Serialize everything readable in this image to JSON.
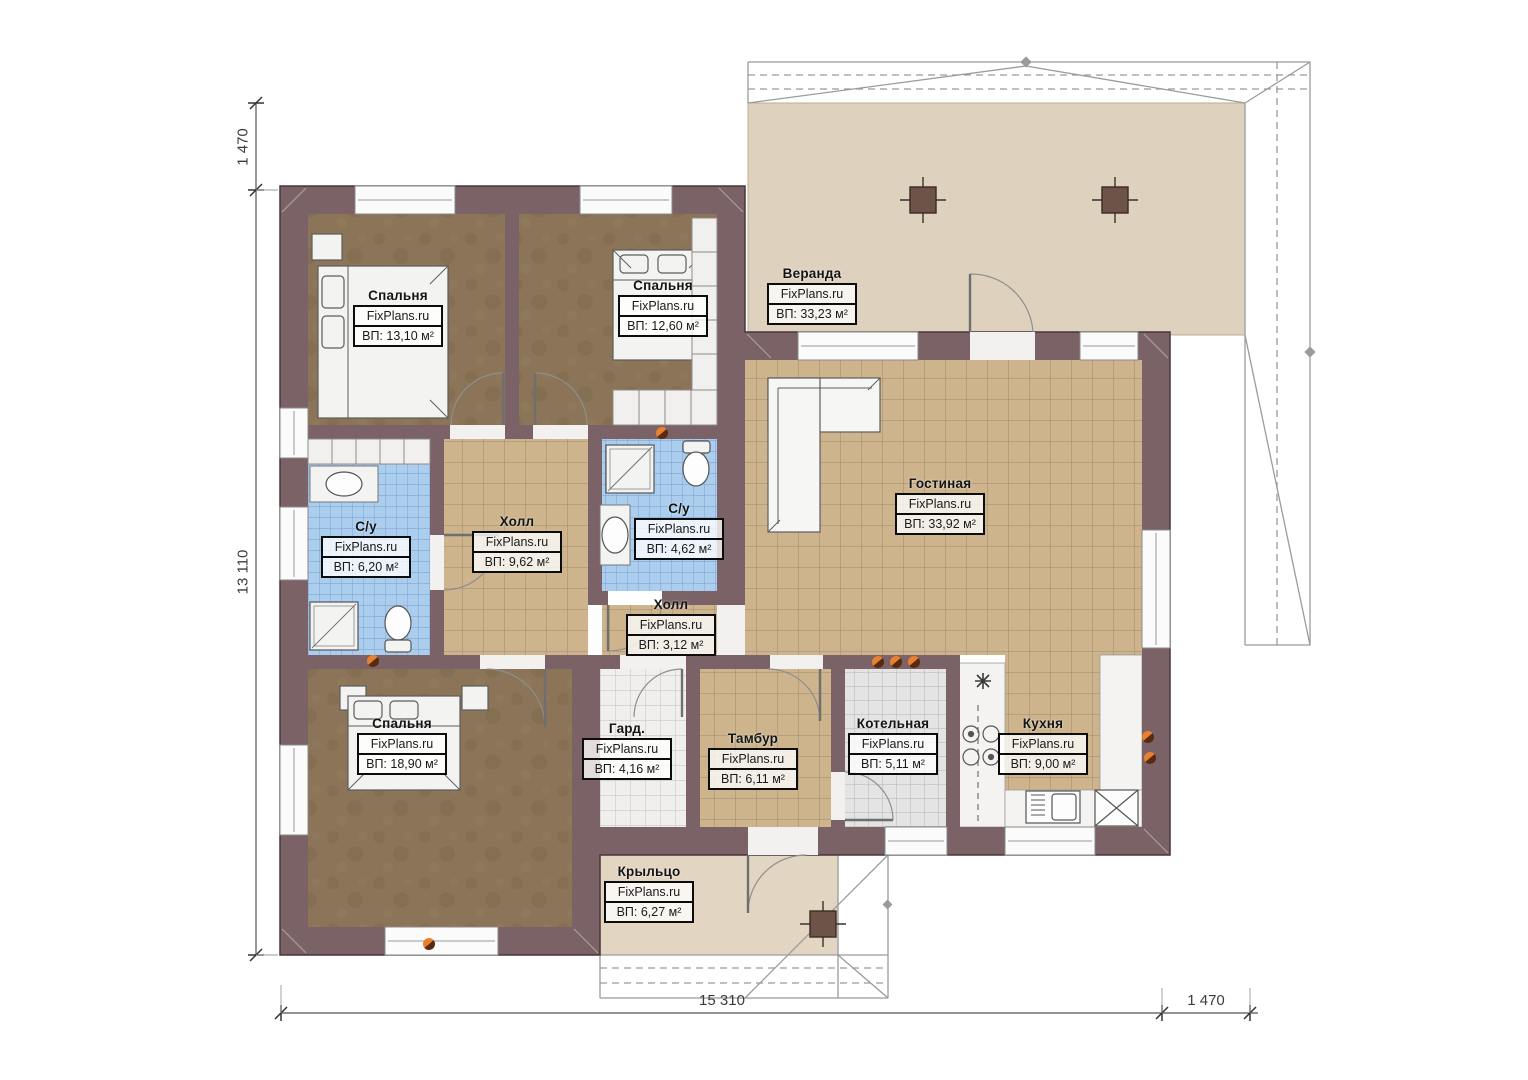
{
  "watermark": "FixPlans.ru",
  "rooms": [
    {
      "id": "bedroom-1",
      "name": "Спальня",
      "area": "ВП: 13,10 м²"
    },
    {
      "id": "bedroom-2",
      "name": "Спальня",
      "area": "ВП: 12,60 м²"
    },
    {
      "id": "veranda",
      "name": "Веранда",
      "area": "ВП: 33,23 м²"
    },
    {
      "id": "living",
      "name": "Гостиная",
      "area": "ВП: 33,92 м²"
    },
    {
      "id": "bath-1",
      "name": "С/у",
      "area": "ВП: 6,20 м²"
    },
    {
      "id": "hall-1",
      "name": "Холл",
      "area": "ВП: 9,62 м²"
    },
    {
      "id": "bath-2",
      "name": "С/у",
      "area": "ВП: 4,62 м²"
    },
    {
      "id": "hall-2",
      "name": "Холл",
      "area": "ВП: 3,12 м²"
    },
    {
      "id": "bedroom-3",
      "name": "Спальня",
      "area": "ВП: 18,90 м²"
    },
    {
      "id": "wardrobe",
      "name": "Гард.",
      "area": "ВП: 4,16 м²"
    },
    {
      "id": "tambur",
      "name": "Тамбур",
      "area": "ВП: 6,11 м²"
    },
    {
      "id": "boiler",
      "name": "Котельная",
      "area": "ВП: 5,11 м²"
    },
    {
      "id": "kitchen",
      "name": "Кухня",
      "area": "ВП: 9,00 м²"
    },
    {
      "id": "porch",
      "name": "Крыльцо",
      "area": "ВП: 6,27 м²"
    }
  ],
  "dimensions": {
    "left_top": "1 470",
    "left_main": "13 110",
    "bottom_main": "15 310",
    "bottom_right": "1 470"
  },
  "colors": {
    "wall": "#7a6266",
    "bedroom_floor": "#8b7457",
    "tile_beige": "#cdb48c",
    "tile_blue": "#abceee",
    "tile_gray": "#e6e6e6",
    "veranda_floor": "#ded2bf",
    "porch_floor": "#e2d6c2",
    "vent_accent": "#e0782a"
  }
}
